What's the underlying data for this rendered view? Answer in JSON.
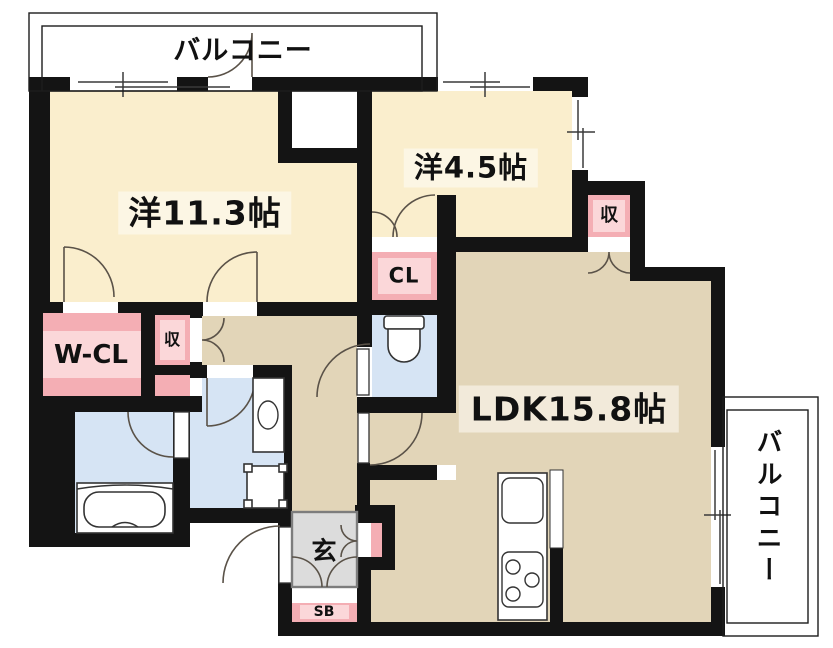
{
  "labels": {
    "balcony_top": "バルコニー",
    "balcony_right": "バルコニー",
    "room_11_3": "洋11.3帖",
    "room_4_5": "洋4.5帖",
    "ldk": "LDK15.8帖",
    "walk_in_closet": "W-CL",
    "closet": "CL",
    "storage_hall": "収",
    "storage_ldk": "収",
    "genkan": "玄",
    "shoe_box": "SB"
  },
  "colors": {
    "wall": "#141414",
    "room_cream": "#FAEECD",
    "ldk_tan": "#E2D5B8",
    "wet_blue": "#D6E4F4",
    "closet_pink": "#F4AEB4",
    "closet_pink_light": "#FBD7D9",
    "genkan_gray": "#DCDCDC",
    "label_bg": "#FCF6E4",
    "label_bg_tan": "#F2EADA"
  }
}
